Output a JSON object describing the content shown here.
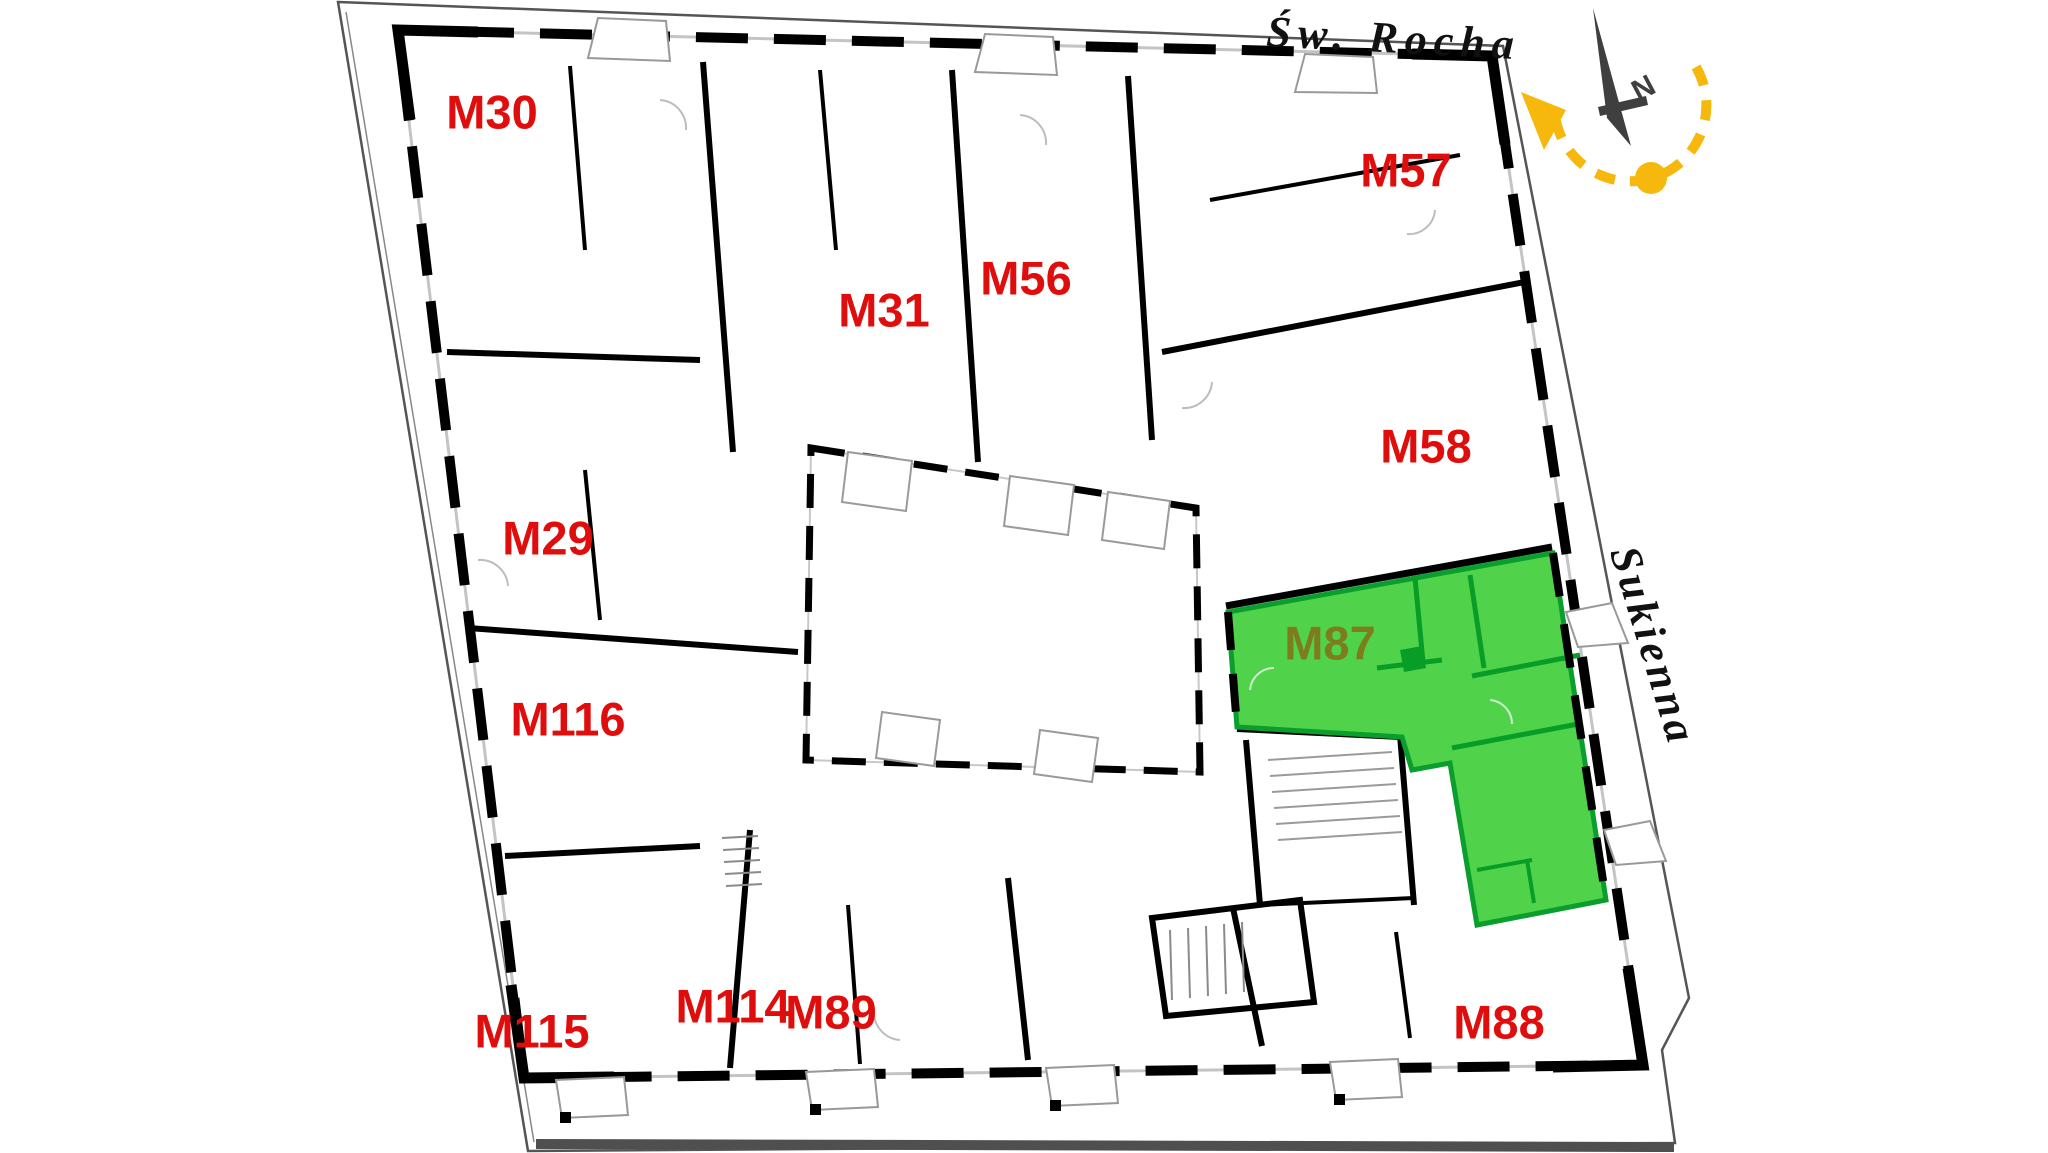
{
  "plan": {
    "type": "building-floor-plan",
    "highlighted_unit": "M87",
    "label_color": "#e00d0d",
    "highlight": {
      "fill_color": "#50d24b",
      "wall_color": "#0a9e2c",
      "label_color": "#7d7d1d"
    }
  },
  "apartments": [
    {
      "id": "M30",
      "label": "M30",
      "highlighted": false
    },
    {
      "id": "M31",
      "label": "M31",
      "highlighted": false
    },
    {
      "id": "M56",
      "label": "M56",
      "highlighted": false
    },
    {
      "id": "M57",
      "label": "M57",
      "highlighted": false
    },
    {
      "id": "M58",
      "label": "M58",
      "highlighted": false
    },
    {
      "id": "M29",
      "label": "M29",
      "highlighted": false
    },
    {
      "id": "M116",
      "label": "M116",
      "highlighted": false
    },
    {
      "id": "M115",
      "label": "M115",
      "highlighted": false
    },
    {
      "id": "M114",
      "label": "M114",
      "highlighted": false
    },
    {
      "id": "M89",
      "label": "M89",
      "highlighted": false
    },
    {
      "id": "M88",
      "label": "M88",
      "highlighted": false
    },
    {
      "id": "M87",
      "label": "M87",
      "highlighted": true
    }
  ],
  "streets": [
    {
      "name": "Św. Rocha",
      "position": "top"
    },
    {
      "name": "Sukienna",
      "position": "right"
    }
  ],
  "compass": {
    "letter": "N",
    "needle_color": "#3f3f3f",
    "arc_color": "#f6b80c"
  }
}
